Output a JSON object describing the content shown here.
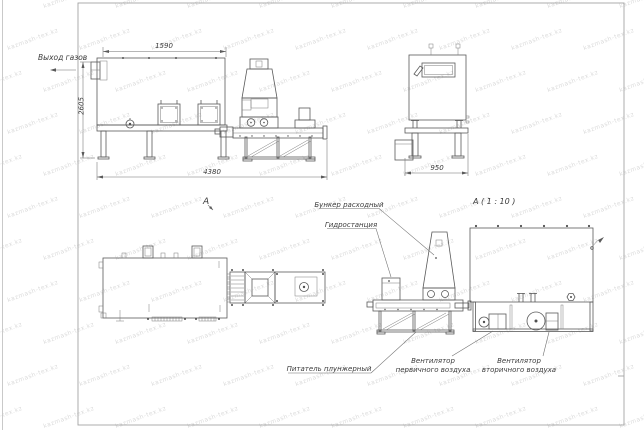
{
  "sheet": {
    "watermark_text": "kazmash-tex.kz"
  },
  "labels": {
    "gas_outlet": "Выход газов",
    "section_mark": "A",
    "detail_title": "A ( 1 : 10 )",
    "feed_hopper": "Бункер расходный",
    "hydraulic_station": "Гидростанция",
    "plunger_feeder": "Питатель плунжерный",
    "primary_air_fan_line1": "Вентилятор",
    "primary_air_fan_line2": "первичного воздуха",
    "secondary_air_fan_line1": "Вентилятор",
    "secondary_air_fan_line2": "вторичного воздуха"
  },
  "dimensions": {
    "furnace_length": "1590",
    "overall_height": "2605",
    "overall_length": "4380",
    "end_view_width": "950"
  },
  "colors": {
    "line": "#5a5a5a",
    "dimension": "#6f6f6f",
    "text": "#3b3b3b",
    "watermark": "#dcdcdc"
  }
}
